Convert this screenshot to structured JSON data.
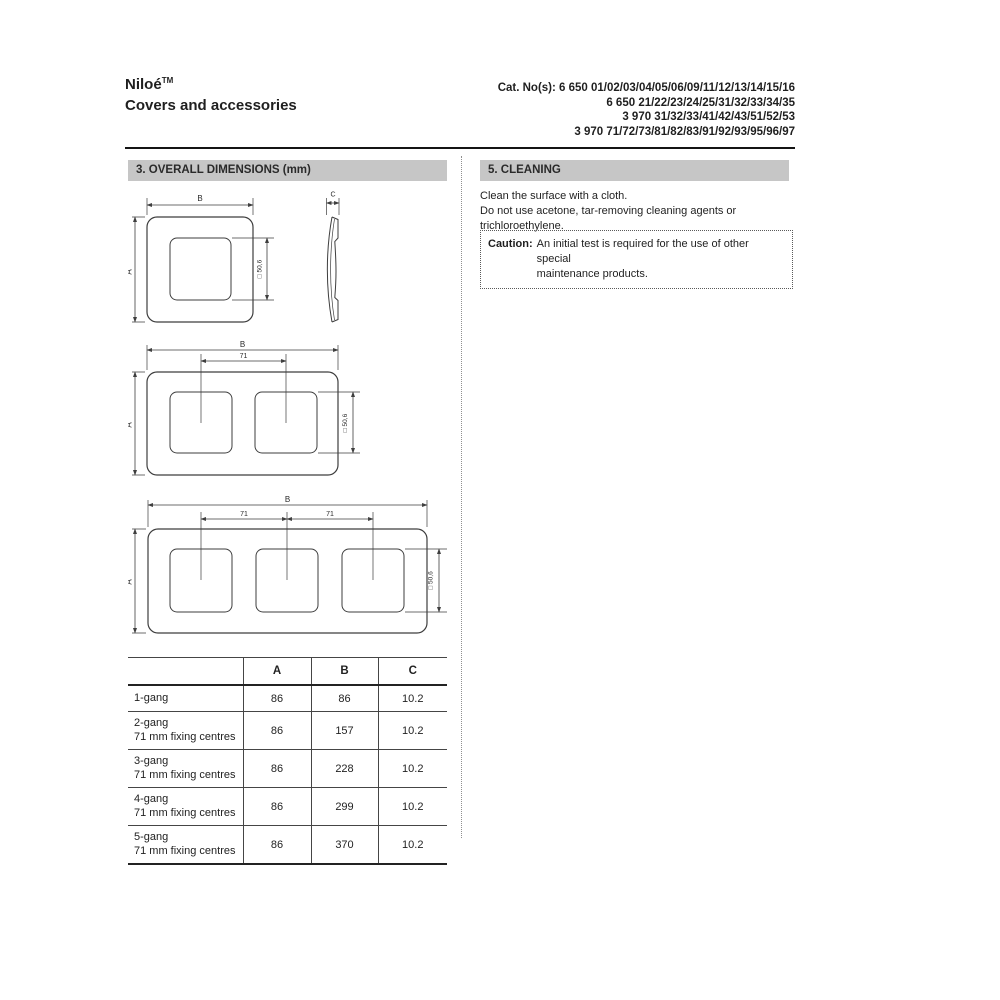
{
  "header": {
    "brand": "Niloé",
    "brand_sup": "TM",
    "subtitle": "Covers and accessories",
    "cat_lines": [
      "Cat. No(s): 6 650 01/02/03/04/05/06/09/11/12/13/14/15/16",
      "6 650 21/22/23/24/25/31/32/33/34/35",
      "3 970 31/32/33/41/42/43/51/52/53",
      "3 970 71/72/73/81/82/83/91/92/93/95/96/97"
    ]
  },
  "sections": {
    "dimensions": {
      "title": "3. OVERALL DIMENSIONS (mm)"
    },
    "cleaning": {
      "title": "5. CLEANING",
      "line1": "Clean the surface with a cloth.",
      "line2": "Do not use acetone, tar-removing cleaning agents or trichloroethylene.",
      "caution_label": "Caution:",
      "caution_line1": "An initial test is required for the use of other special",
      "caution_line2": "maintenance products."
    }
  },
  "diagrams": {
    "labels": {
      "a": "A",
      "b": "B",
      "c": "C",
      "centres": "71",
      "window": "□ 50,6"
    }
  },
  "table": {
    "headers": [
      "",
      "A",
      "B",
      "C"
    ],
    "rows": [
      {
        "name": "1-gang",
        "sub": "",
        "a": "86",
        "b": "86",
        "c": "10.2"
      },
      {
        "name": "2-gang",
        "sub": "71 mm fixing centres",
        "a": "86",
        "b": "157",
        "c": "10.2"
      },
      {
        "name": "3-gang",
        "sub": "71 mm fixing centres",
        "a": "86",
        "b": "228",
        "c": "10.2"
      },
      {
        "name": "4-gang",
        "sub": "71 mm fixing centres",
        "a": "86",
        "b": "299",
        "c": "10.2"
      },
      {
        "name": "5-gang",
        "sub": "71 mm fixing centres",
        "a": "86",
        "b": "370",
        "c": "10.2"
      }
    ]
  }
}
